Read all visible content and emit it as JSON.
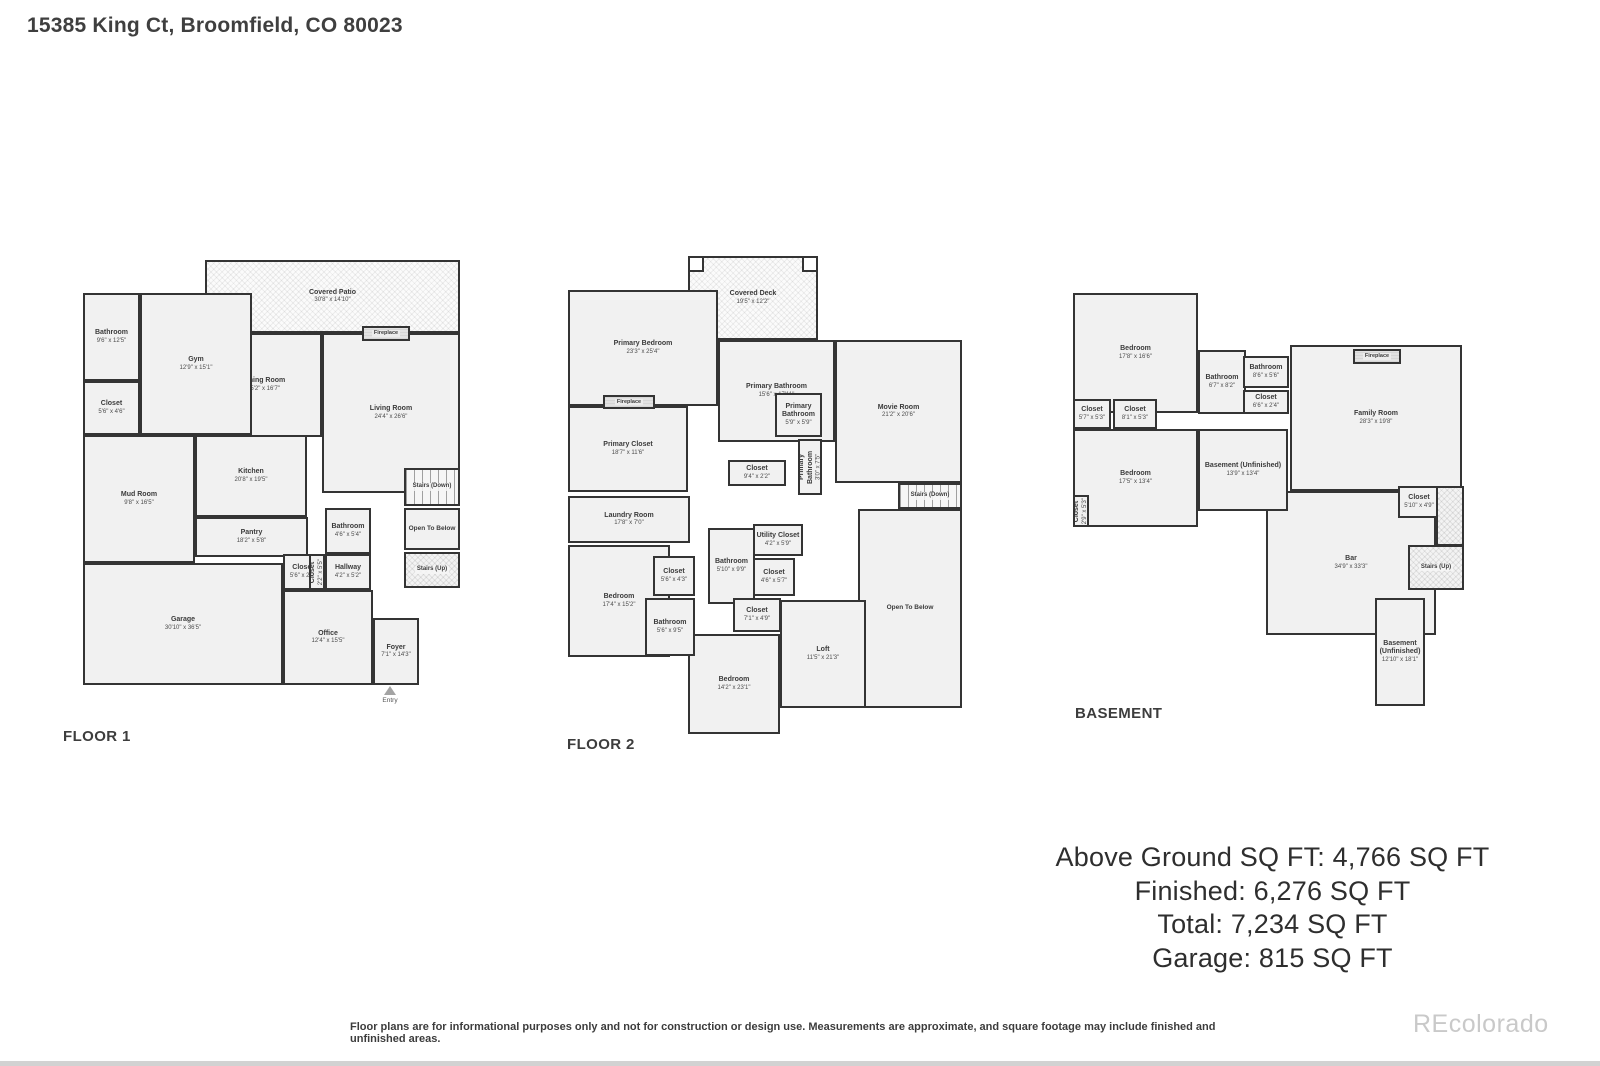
{
  "page": {
    "title": "15385 King Ct, Broomfield, CO 80023",
    "watermark": "REcolorado",
    "disclaimer": "Floor plans are for informational purposes only and not for construction or design use. Measurements are approximate, and square footage may include finished and unfinished areas.",
    "colors": {
      "wall": "#343434",
      "room_fill": "#f1f1f1",
      "text": "#3b3b3b",
      "watermark": "#c9c9c9"
    }
  },
  "summary": {
    "lines": [
      "Above Ground SQ FT: 4,766 SQ FT",
      "Finished: 6,276 SQ FT",
      "Total: 7,234 SQ FT",
      "Garage: 815 SQ FT"
    ]
  },
  "floors": [
    {
      "label": "FLOOR 1",
      "label_pos": {
        "x": 63,
        "y": 728
      },
      "rooms": [
        {
          "name": "Covered Patio",
          "dims": "30'8\" x 14'10\"",
          "x": 205,
          "y": 260,
          "w": 255,
          "h": 73,
          "kind": "hatch"
        },
        {
          "name": "Living Room",
          "dims": "24'4\" x 26'6\"",
          "x": 322,
          "y": 333,
          "w": 138,
          "h": 160,
          "kind": "room"
        },
        {
          "name": "Dining Room",
          "dims": "15'2\" x 16'7\"",
          "x": 205,
          "y": 333,
          "w": 117,
          "h": 104,
          "kind": "room"
        },
        {
          "name": "Gym",
          "dims": "12'9\" x 15'1\"",
          "x": 140,
          "y": 293,
          "w": 112,
          "h": 142,
          "kind": "room"
        },
        {
          "name": "Bathroom",
          "dims": "9'6\" x 12'5\"",
          "x": 83,
          "y": 293,
          "w": 57,
          "h": 88,
          "kind": "room"
        },
        {
          "name": "Closet",
          "dims": "5'6\" x 4'6\"",
          "x": 83,
          "y": 381,
          "w": 57,
          "h": 54,
          "kind": "room"
        },
        {
          "name": "Mud Room",
          "dims": "9'8\" x 16'5\"",
          "x": 83,
          "y": 435,
          "w": 112,
          "h": 128,
          "kind": "room"
        },
        {
          "name": "Kitchen",
          "dims": "20'8\" x 19'5\"",
          "x": 195,
          "y": 435,
          "w": 112,
          "h": 82,
          "kind": "room"
        },
        {
          "name": "Garage",
          "dims": "30'10\" x 36'5\"",
          "x": 83,
          "y": 563,
          "w": 200,
          "h": 122,
          "kind": "room"
        },
        {
          "name": "Office",
          "dims": "12'4\" x 15'5\"",
          "x": 283,
          "y": 590,
          "w": 90,
          "h": 95,
          "kind": "room"
        },
        {
          "name": "Foyer",
          "dims": "7'1\" x 14'3\"",
          "x": 373,
          "y": 618,
          "w": 46,
          "h": 67,
          "kind": "room"
        },
        {
          "name": "Pantry",
          "dims": "18'2\" x 5'8\"",
          "x": 195,
          "y": 517,
          "w": 113,
          "h": 40,
          "kind": "room"
        },
        {
          "name": "Bathroom",
          "dims": "4'6\" x 5'4\"",
          "x": 325,
          "y": 508,
          "w": 46,
          "h": 46,
          "kind": "room"
        },
        {
          "name": "Stairs (Down)",
          "dims": "",
          "x": 404,
          "y": 468,
          "w": 56,
          "h": 38,
          "kind": "stairs"
        },
        {
          "name": "Open To Below",
          "dims": "",
          "x": 404,
          "y": 508,
          "w": 56,
          "h": 42,
          "kind": "open"
        },
        {
          "name": "Stairs (Up)",
          "dims": "",
          "x": 404,
          "y": 552,
          "w": 56,
          "h": 36,
          "kind": "stairs-hatch"
        },
        {
          "name": "Closet",
          "dims": "5'6\" x 2'5\"",
          "x": 283,
          "y": 554,
          "w": 40,
          "h": 36,
          "kind": "room"
        },
        {
          "name": "Closet",
          "dims": "2'2\" x 5'5\"",
          "x": 309,
          "y": 554,
          "w": 16,
          "h": 36,
          "kind": "room",
          "vert": true
        },
        {
          "name": "Hallway",
          "dims": "4'2\" x 5'2\"",
          "x": 325,
          "y": 554,
          "w": 46,
          "h": 36,
          "kind": "room"
        },
        {
          "name": "Fireplace",
          "dims": "",
          "x": 362,
          "y": 326,
          "w": 48,
          "h": 15,
          "kind": "fireplace"
        },
        {
          "name": "Entry",
          "dims": "",
          "x": 378,
          "y": 686,
          "w": 24,
          "h": 20,
          "kind": "entry"
        }
      ]
    },
    {
      "label": "FLOOR 2",
      "label_pos": {
        "x": 567,
        "y": 736
      },
      "rooms": [
        {
          "name": "Covered Deck",
          "dims": "19'5\" x 12'2\"",
          "x": 688,
          "y": 256,
          "w": 130,
          "h": 84,
          "kind": "hatch"
        },
        {
          "name": "Primary Bedroom",
          "dims": "23'3\" x 25'4\"",
          "x": 568,
          "y": 290,
          "w": 150,
          "h": 116,
          "kind": "room"
        },
        {
          "name": "Primary Bathroom",
          "dims": "15'6\" x 17'11\"",
          "x": 718,
          "y": 340,
          "w": 117,
          "h": 102,
          "kind": "room"
        },
        {
          "name": "Movie Room",
          "dims": "21'2\" x 20'6\"",
          "x": 835,
          "y": 340,
          "w": 127,
          "h": 143,
          "kind": "room"
        },
        {
          "name": "Primary Closet",
          "dims": "18'7\" x 11'6\"",
          "x": 568,
          "y": 406,
          "w": 120,
          "h": 86,
          "kind": "room"
        },
        {
          "name": "Laundry Room",
          "dims": "17'8\" x 7'0\"",
          "x": 568,
          "y": 496,
          "w": 122,
          "h": 47,
          "kind": "room"
        },
        {
          "name": "Bedroom",
          "dims": "17'4\" x 15'2\"",
          "x": 568,
          "y": 545,
          "w": 102,
          "h": 112,
          "kind": "room"
        },
        {
          "name": "Open To Below",
          "dims": "",
          "x": 858,
          "y": 509,
          "w": 104,
          "h": 199,
          "kind": "open"
        },
        {
          "name": "Loft",
          "dims": "11'5\" x 21'3\"",
          "x": 780,
          "y": 600,
          "w": 86,
          "h": 108,
          "kind": "room"
        },
        {
          "name": "Bedroom",
          "dims": "14'2\" x 23'1\"",
          "x": 688,
          "y": 634,
          "w": 92,
          "h": 100,
          "kind": "room"
        },
        {
          "name": "Bathroom",
          "dims": "5'10\" x 9'9\"",
          "x": 708,
          "y": 528,
          "w": 47,
          "h": 76,
          "kind": "room"
        },
        {
          "name": "Primary Bathroom",
          "dims": "5'9\" x 5'9\"",
          "x": 775,
          "y": 393,
          "w": 47,
          "h": 44,
          "kind": "room"
        },
        {
          "name": "Primary Bathroom",
          "dims": "3'0\" x 7'5\"",
          "x": 798,
          "y": 439,
          "w": 24,
          "h": 56,
          "kind": "room",
          "vert": true
        },
        {
          "name": "Closet",
          "dims": "9'4\" x 2'2\"",
          "x": 728,
          "y": 460,
          "w": 58,
          "h": 26,
          "kind": "room"
        },
        {
          "name": "Stairs (Down)",
          "dims": "",
          "x": 898,
          "y": 483,
          "w": 64,
          "h": 26,
          "kind": "stairs"
        },
        {
          "name": "Closet",
          "dims": "5'6\" x 4'3\"",
          "x": 653,
          "y": 556,
          "w": 42,
          "h": 40,
          "kind": "room"
        },
        {
          "name": "Bathroom",
          "dims": "5'6\" x 9'5\"",
          "x": 645,
          "y": 598,
          "w": 50,
          "h": 58,
          "kind": "room"
        },
        {
          "name": "Utility Closet",
          "dims": "4'2\" x 5'9\"",
          "x": 753,
          "y": 524,
          "w": 50,
          "h": 32,
          "kind": "room"
        },
        {
          "name": "Closet",
          "dims": "4'6\" x 5'7\"",
          "x": 753,
          "y": 558,
          "w": 42,
          "h": 38,
          "kind": "room"
        },
        {
          "name": "Closet",
          "dims": "7'1\" x 4'9\"",
          "x": 733,
          "y": 598,
          "w": 48,
          "h": 34,
          "kind": "room"
        },
        {
          "name": "Fireplace",
          "dims": "",
          "x": 603,
          "y": 395,
          "w": 52,
          "h": 14,
          "kind": "fireplace"
        },
        {
          "name": "Deck Post",
          "dims": "",
          "x": 688,
          "y": 256,
          "w": 16,
          "h": 16,
          "kind": "post"
        },
        {
          "name": "Deck Post",
          "dims": "",
          "x": 802,
          "y": 256,
          "w": 16,
          "h": 16,
          "kind": "post"
        }
      ]
    },
    {
      "label": "BASEMENT",
      "label_pos": {
        "x": 1075,
        "y": 705
      },
      "rooms": [
        {
          "name": "Bedroom",
          "dims": "17'8\" x 16'6\"",
          "x": 1073,
          "y": 293,
          "w": 125,
          "h": 120,
          "kind": "room"
        },
        {
          "name": "Family Room",
          "dims": "28'3\" x 19'8\"",
          "x": 1290,
          "y": 345,
          "w": 172,
          "h": 146,
          "kind": "room"
        },
        {
          "name": "Bedroom",
          "dims": "17'5\" x 13'4\"",
          "x": 1073,
          "y": 429,
          "w": 125,
          "h": 98,
          "kind": "room"
        },
        {
          "name": "Bar",
          "dims": "34'9\" x 33'3\"",
          "x": 1266,
          "y": 491,
          "w": 170,
          "h": 144,
          "kind": "room"
        },
        {
          "name": "Bathroom",
          "dims": "6'7\" x 8'2\"",
          "x": 1198,
          "y": 350,
          "w": 48,
          "h": 64,
          "kind": "room"
        },
        {
          "name": "Bathroom",
          "dims": "8'6\" x 5'6\"",
          "x": 1243,
          "y": 356,
          "w": 46,
          "h": 32,
          "kind": "room"
        },
        {
          "name": "Closet",
          "dims": "6'6\" x 2'4\"",
          "x": 1243,
          "y": 390,
          "w": 46,
          "h": 24,
          "kind": "room"
        },
        {
          "name": "Closet",
          "dims": "5'7\" x 5'3\"",
          "x": 1073,
          "y": 399,
          "w": 38,
          "h": 30,
          "kind": "room"
        },
        {
          "name": "Closet",
          "dims": "8'1\" x 5'3\"",
          "x": 1113,
          "y": 399,
          "w": 44,
          "h": 30,
          "kind": "room"
        },
        {
          "name": "Basement (Unfinished)",
          "dims": "13'9\" x 13'4\"",
          "x": 1198,
          "y": 429,
          "w": 90,
          "h": 82,
          "kind": "room"
        },
        {
          "name": "Closet",
          "dims": "2'9\" x 5'3\"",
          "x": 1073,
          "y": 495,
          "w": 16,
          "h": 32,
          "kind": "room",
          "vert": true
        },
        {
          "name": "Closet",
          "dims": "5'10\" x 4'9\"",
          "x": 1398,
          "y": 486,
          "w": 42,
          "h": 32,
          "kind": "room"
        },
        {
          "name": "Stairs Hatch",
          "dims": "",
          "x": 1436,
          "y": 486,
          "w": 28,
          "h": 60,
          "kind": "stairs-hatch",
          "nolabel": true
        },
        {
          "name": "Stairs (Up)",
          "dims": "",
          "x": 1408,
          "y": 545,
          "w": 56,
          "h": 45,
          "kind": "stairs-hatch"
        },
        {
          "name": "Basement (Unfinished)",
          "dims": "12'10\" x 18'1\"",
          "x": 1375,
          "y": 598,
          "w": 50,
          "h": 108,
          "kind": "room"
        },
        {
          "name": "Fireplace",
          "dims": "",
          "x": 1353,
          "y": 349,
          "w": 48,
          "h": 15,
          "kind": "fireplace"
        }
      ]
    }
  ]
}
